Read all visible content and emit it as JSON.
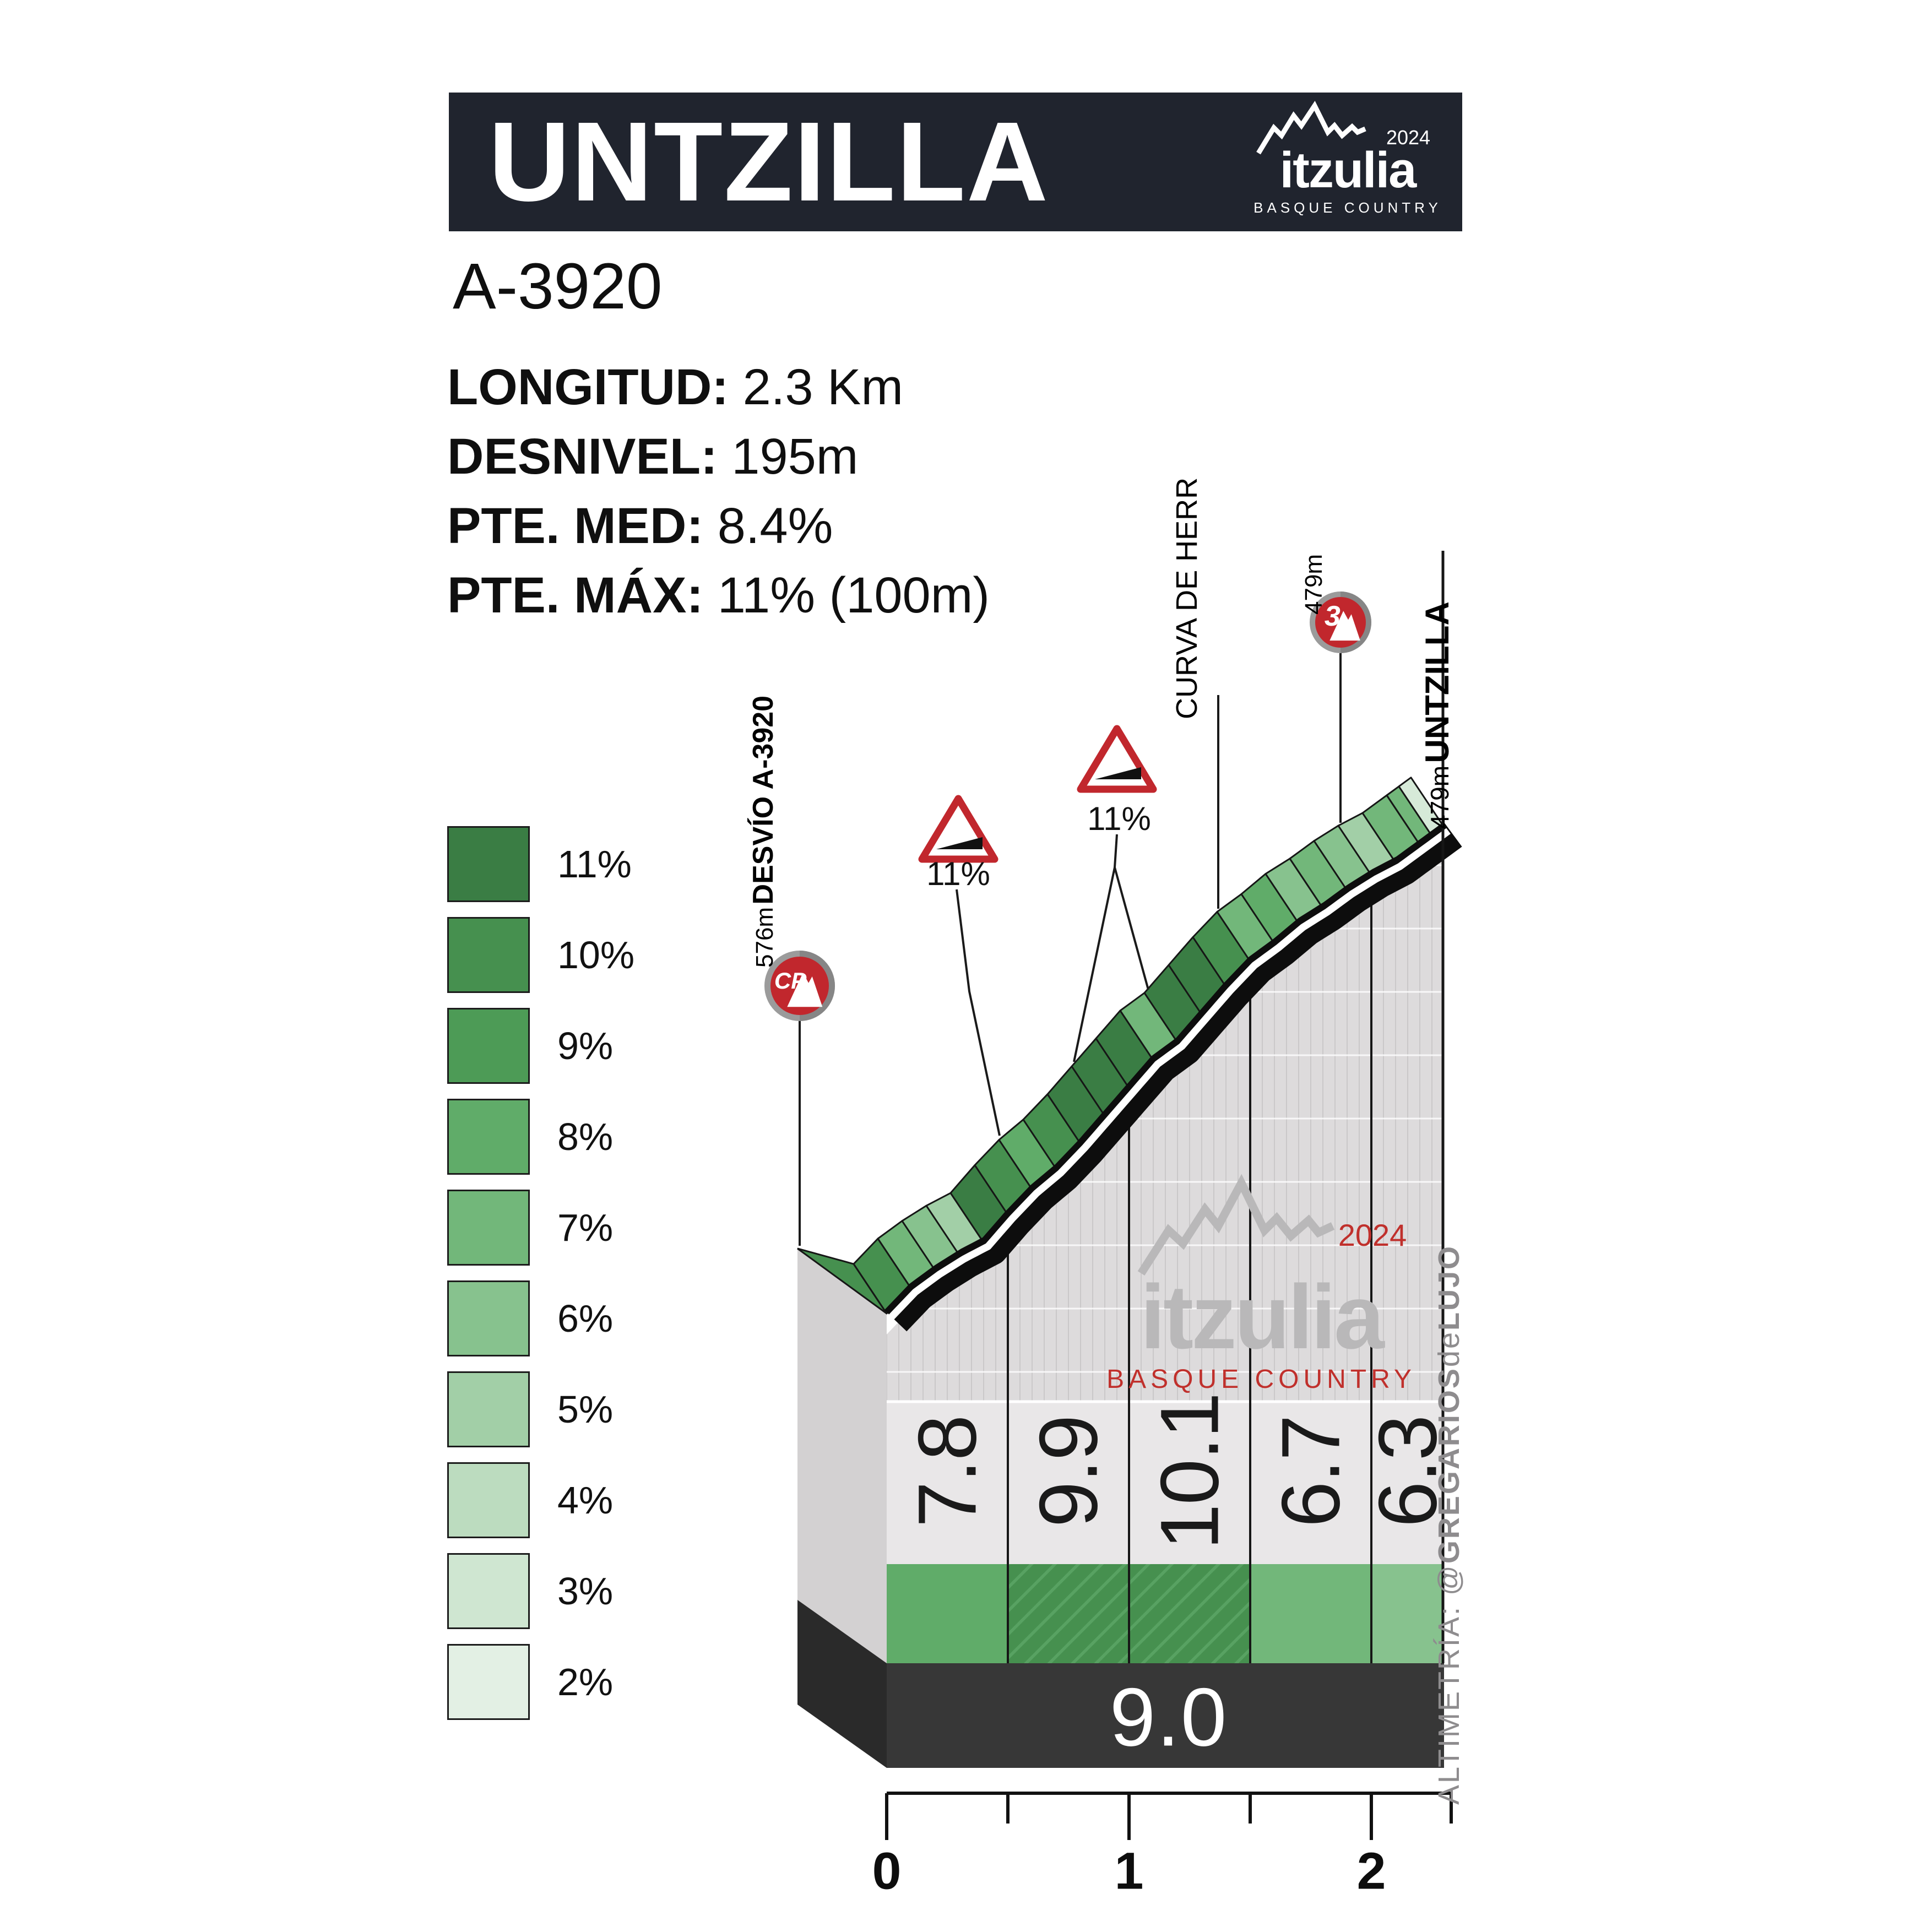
{
  "header": {
    "title": "UNTZILLA",
    "logo": {
      "brand": "itzulia",
      "year": "2024",
      "region": "BASQUE COUNTRY"
    }
  },
  "road_ref": "A-3920",
  "stats": {
    "items": [
      {
        "label": "LONGITUD:",
        "value": "2.3 Km"
      },
      {
        "label": "DESNIVEL:",
        "value": "195m"
      },
      {
        "label": "PTE. MED:",
        "value": "8.4%"
      },
      {
        "label": "PTE. MÁX:",
        "value": "11% (100m)"
      }
    ]
  },
  "legend": [
    {
      "label": "11%",
      "pct": 11,
      "color": "#3a7d44"
    },
    {
      "label": "10%",
      "pct": 10,
      "color": "#46904f"
    },
    {
      "label": "9%",
      "pct": 9,
      "color": "#4d9b56"
    },
    {
      "label": "8%",
      "pct": 8,
      "color": "#60ac69"
    },
    {
      "label": "7%",
      "pct": 7,
      "color": "#72b77a"
    },
    {
      "label": "6%",
      "pct": 6,
      "color": "#87c28e"
    },
    {
      "label": "5%",
      "pct": 5,
      "color": "#a2cfa7"
    },
    {
      "label": "4%",
      "pct": 4,
      "color": "#bcdcbf"
    },
    {
      "label": "3%",
      "pct": 3,
      "color": "#cfe6d1"
    },
    {
      "label": "2%",
      "pct": 2,
      "color": "#e3f0e4"
    }
  ],
  "annotations": {
    "start": {
      "elevation": "576m",
      "name": "DESVÍO A-3920"
    },
    "curve": {
      "name": "CURVA DE HERR"
    },
    "cat3": {
      "elevation": "479m",
      "category": "3"
    },
    "summit": {
      "elevation": "479m",
      "name": "UNTZILLA"
    },
    "cp_badge": "CP",
    "signs": [
      {
        "label": "11%"
      },
      {
        "label": "11%"
      }
    ]
  },
  "watermark": {
    "brand": "itzulia",
    "year": "2024",
    "region": "BASQUE COUNTRY"
  },
  "credit": {
    "prefix": "ALTIMETRÍA: @",
    "bold1": "GREGARIOS",
    "mid": "de",
    "bold2": "LUJO"
  },
  "chart_data": {
    "type": "area",
    "title": "UNTZILLA (A-3920) climb profile",
    "xlabel": "km",
    "ylabel": "elevation (m)",
    "length_km": 2.3,
    "total_climb_m": 195,
    "avg_gradient_pct": 8.4,
    "max_gradient_pct_100m": 11,
    "start_elevation_label_m": 576,
    "summit_elevation_m": 479,
    "total_avg_value": "9.0",
    "x_ticks": [
      "0",
      "1",
      "2"
    ],
    "sections": [
      {
        "from_km": 0.0,
        "to_km": 0.5,
        "avg_pct": "7.8",
        "color_pct": 8,
        "hatch": false
      },
      {
        "from_km": 0.5,
        "to_km": 1.0,
        "avg_pct": "9.9",
        "color_pct": 10,
        "hatch": true
      },
      {
        "from_km": 1.0,
        "to_km": 1.5,
        "avg_pct": "10.1",
        "color_pct": 10,
        "hatch": true
      },
      {
        "from_km": 1.5,
        "to_km": 2.0,
        "avg_pct": "6.7",
        "color_pct": 7,
        "hatch": false
      },
      {
        "from_km": 2.0,
        "to_km": 2.3,
        "avg_pct": "6.3",
        "color_pct": 6,
        "hatch": false
      }
    ],
    "bands_100m_estimated_pct": [
      10,
      7,
      6,
      5,
      11,
      10,
      8,
      10,
      11,
      11,
      11,
      7,
      11,
      11,
      10,
      7,
      8,
      6,
      7,
      6,
      5,
      7,
      7
    ],
    "grid": true,
    "legend_position": "left"
  }
}
